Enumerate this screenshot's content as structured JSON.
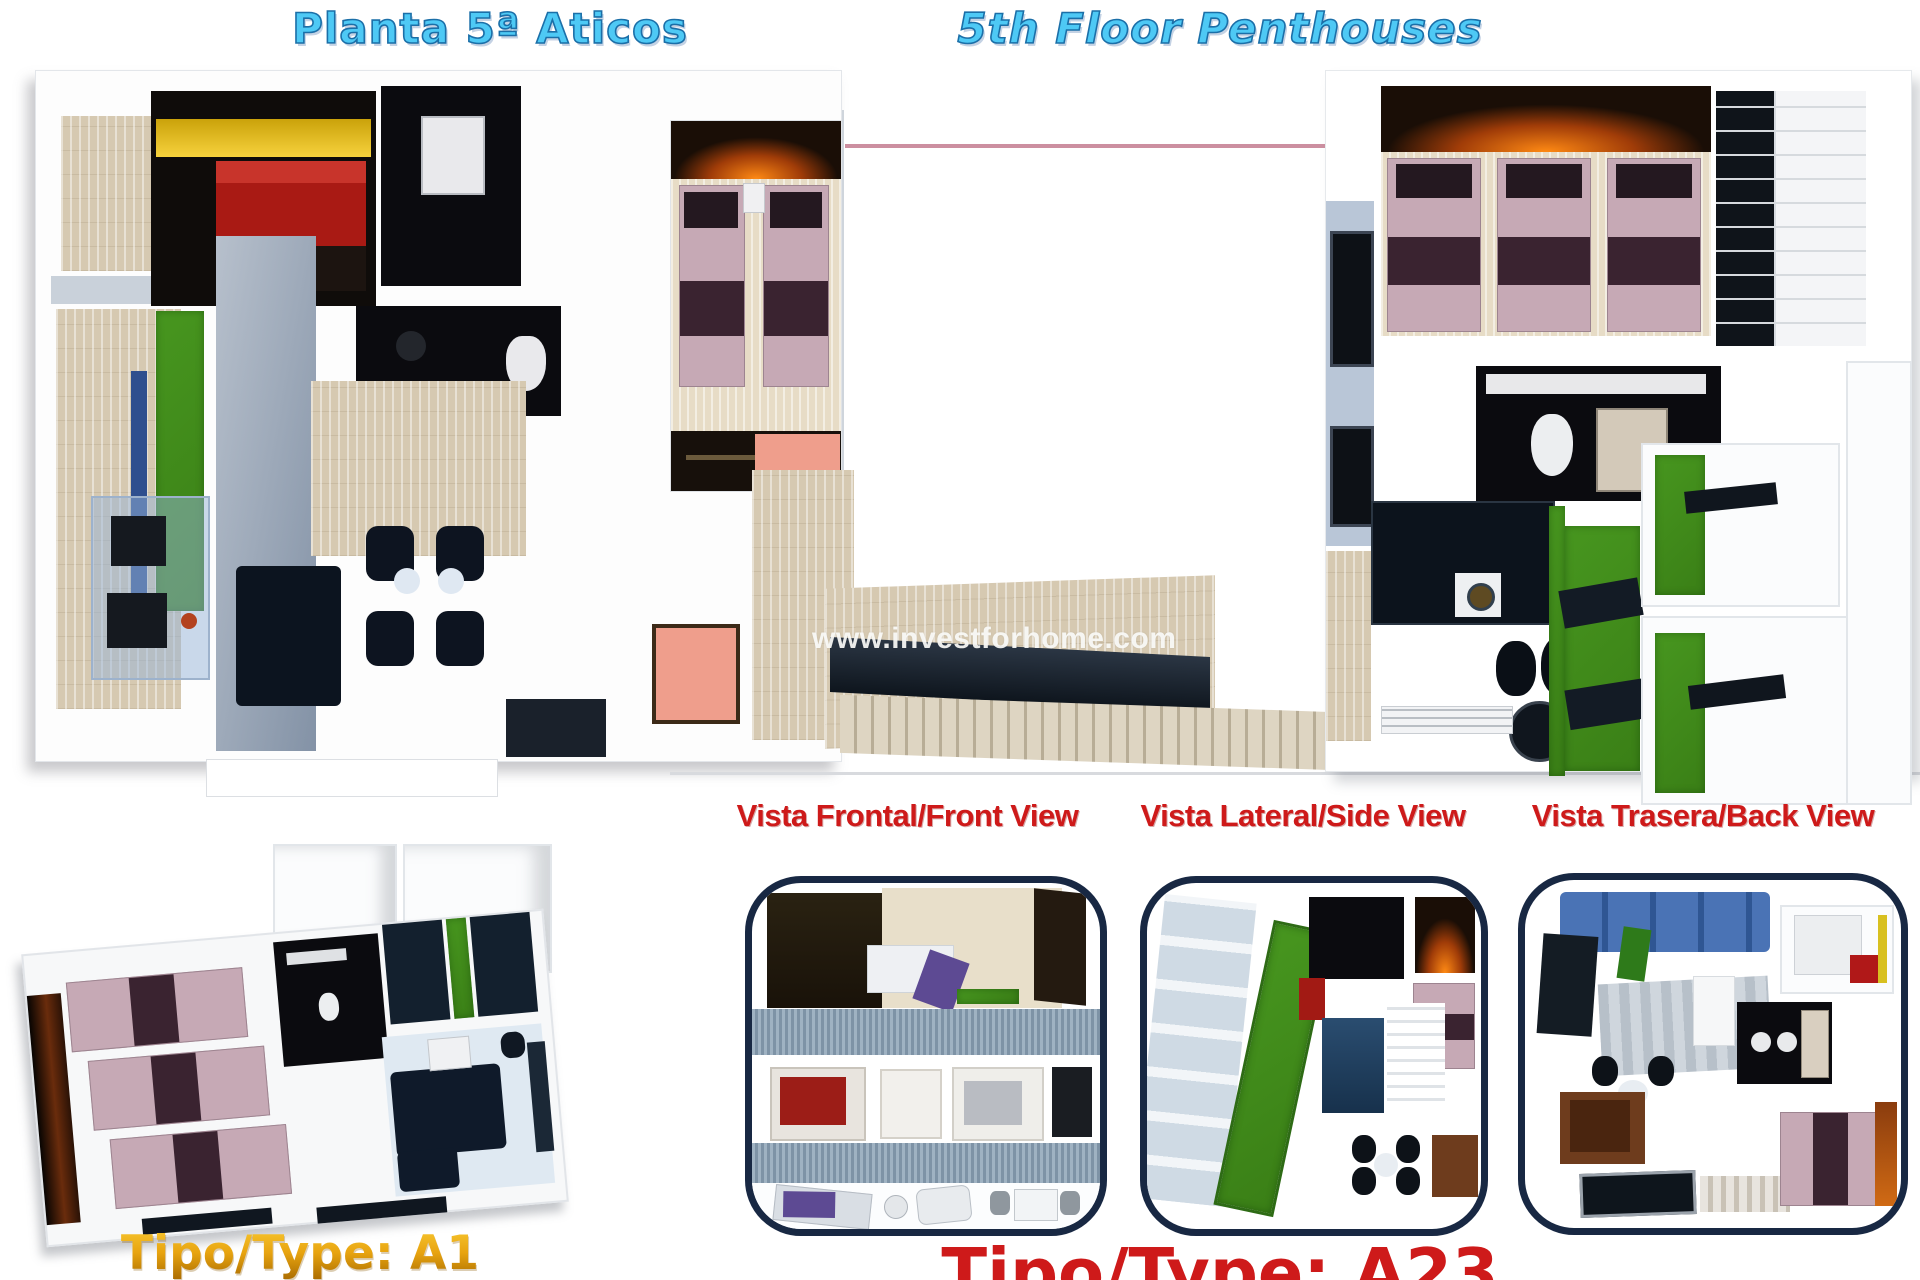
{
  "header": {
    "title_es": "Planta 5ª Aticos",
    "title_en": "5th Floor Penthouses"
  },
  "watermark": "www.investforhome.com",
  "views": [
    {
      "label": "Vista Frontal/Front View"
    },
    {
      "label": "Vista Lateral/Side View"
    },
    {
      "label": "Vista Trasera/Back View"
    }
  ],
  "unit_types": {
    "left": "Tipo/Type: A1",
    "bottom": "Tipo/Type: A23"
  },
  "colors": {
    "title_blue": "#4ec9f5",
    "title_outline": "#1b6fa8",
    "label_red": "#ce1a1a",
    "gold": "#e0a312",
    "panel_border_navy": "#182843",
    "grass_green": "#3f8d1d",
    "tile_beige": "#d6c9b1",
    "bed_mauve": "#c6a9b5",
    "accent_salmon": "#ef9e8c",
    "courtyard_line_pink": "#cc8fa0"
  }
}
